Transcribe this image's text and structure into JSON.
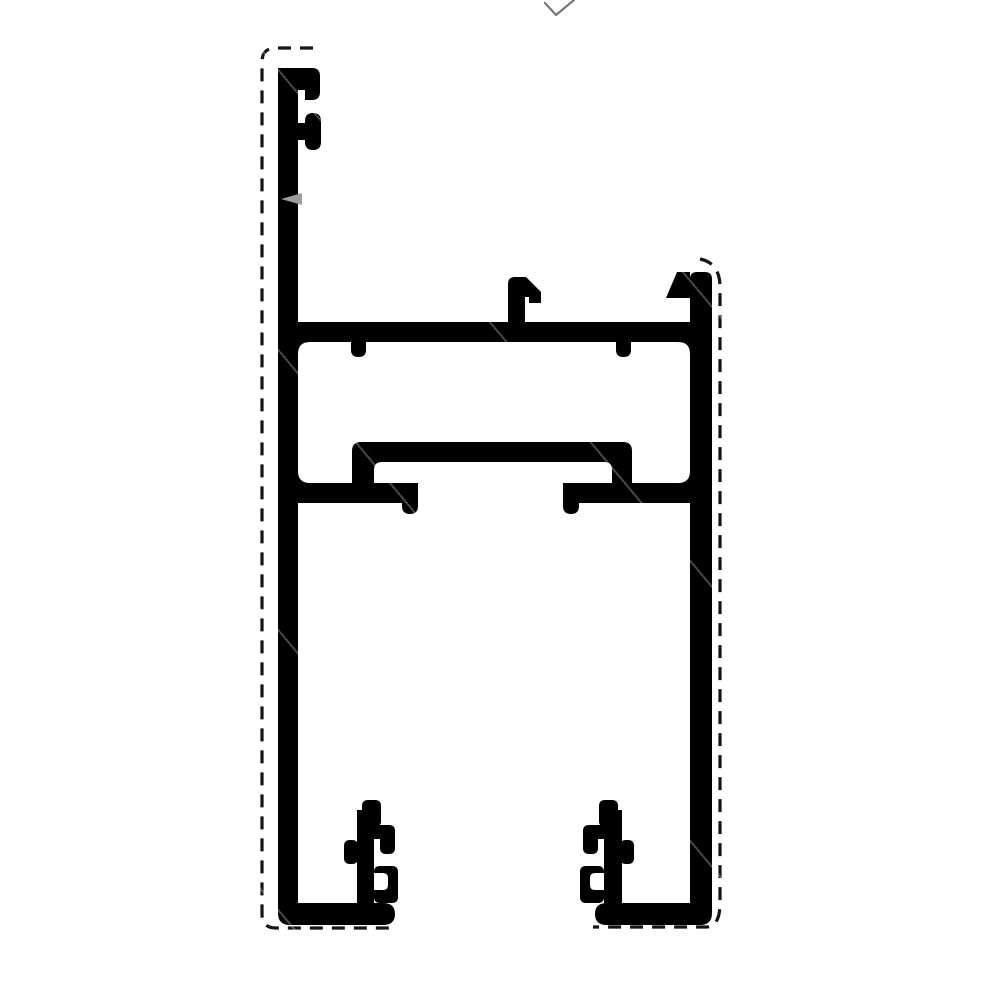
{
  "meta": {
    "title": "Aluminium sliding-frame profile cross-section drawing",
    "canvas": {
      "width": 1000,
      "height": 1000
    }
  },
  "colors": {
    "background": "#ffffff",
    "ink": "#000000",
    "dash": "#151515",
    "pointer": "#9d9d9d",
    "check": "#777777"
  },
  "drawing": {
    "paths": [
      {
        "name": "dashed-outline-left",
        "d": "M313,48 H276 Q262,48 262,62 V914 Q262,928 276,928 H390"
      },
      {
        "name": "dashed-outline-right",
        "d": "M700,259 Q720,263 720,287 V903 Q720,927 706,927 H593"
      },
      {
        "name": "upper-chamber-body",
        "d": "M278,322 H712 V503 H278 Z"
      },
      {
        "name": "upper-chamber-cavity",
        "d": "M310,342 H678 Q690,342 690,354 V471 Q690,483 678,483 H310 Q298,483 298,471 V354 Q298,342 310,342 Z"
      },
      {
        "name": "glazing-hat-body",
        "d": "M352,451 Q352,442 361,442 H623 Q632,442 632,451 V503 H352 Z"
      },
      {
        "name": "glazing-hat-cavity",
        "d": "M382,462 H604 Q612,462 612,470 V483 H374 V470 Q374,462 382,462 Z"
      },
      {
        "name": "under-hat-gap",
        "d": "M418,483 H563 V503 H418 Z"
      },
      {
        "name": "gap-lip-left",
        "d": "M402,494 H418 V506 Q418,514 410,514 Q402,514 402,506 Z"
      },
      {
        "name": "gap-lip-right",
        "d": "M563,494 H579 V506 Q579,514 571,514 Q563,514 563,506 Z"
      },
      {
        "name": "web-nub-left",
        "d": "M351,342 H366 V350 Q366,357 358.5,357 Q351,357 351,350 Z"
      },
      {
        "name": "web-nub-right",
        "d": "M616,342 H631 V350 Q631,357 623.5,357 Q616,357 616,350 Z"
      },
      {
        "name": "center-hook",
        "d": "M508,338 V284 Q508,277 515,277 H526 L541,292 V303 H529 V297 H525 V338 Z"
      },
      {
        "name": "right-top-flag",
        "d": "M677,272 H690 V298 H666 Z"
      },
      {
        "name": "left-wall",
        "d": "M278,75 Q278,68 285,68 H298 V910 H278 Z"
      },
      {
        "name": "left-wall-top-arm",
        "d": "M278,68 H312 Q320,68 320,76 V92 Q320,100 312,100 H305 V90 H278 Z"
      },
      {
        "name": "left-wall-knob",
        "d": "M313,113 Q321,113 321,121 V142 Q321,150 313,150 Q305,150 305,142 V121 Q305,113 313,113 Z M296,123 H306 V140 H296 Z"
      },
      {
        "name": "right-wall",
        "d": "M690,279 Q690,272 697,272 H705 Q712,272 712,279 V910 H690 Z"
      },
      {
        "name": "left-foot-base",
        "d": "M278,888 H298 V903 H383 Q395,903 395,914 Q395,925 383,925 H290 Q278,925 278,913 Z"
      },
      {
        "name": "right-foot-base",
        "d": "M712,888 V913 Q712,925 700,925 H607 Q595,925 595,914 Q595,903 607,903 H690 V888 Z"
      },
      {
        "name": "left-foot-rib",
        "d": "M357,810 H374 V903 H357 Z"
      },
      {
        "name": "left-rib-top-knob",
        "d": "M368,800 H375 Q381,800 381,806 V821 Q381,827 375,827 H368 Q362,827 362,821 V806 Q362,800 368,800 Z"
      },
      {
        "name": "left-rib-finger",
        "d": "M374,825 H389 Q395,825 395,831 V848 Q395,854 389,854 H386 Q380,854 380,848 V839 H374 Z"
      },
      {
        "name": "left-rib-side-knob",
        "d": "M350,840 H352 Q358,840 358,846 V858 Q358,864 352,864 H350 Q344,864 344,858 V846 Q344,840 350,840 Z"
      },
      {
        "name": "left-rib-hook-body",
        "d": "M380,866 H392 Q398,866 398,872 V897 Q398,903 392,903 H380 Q374,903 374,897 V872 Q374,866 380,866 Z"
      },
      {
        "name": "left-rib-hook-notch",
        "d": "M374,873 H383 Q388,873 388,878 V885 Q388,890 383,890 H374 Z"
      },
      {
        "name": "right-foot-rib",
        "d": "M604,810 H622 V903 H604 Z"
      },
      {
        "name": "right-rib-top-knob",
        "d": "M605,800 H612 Q618,800 618,806 V821 Q618,827 612,827 H605 Q599,827 599,821 V806 Q599,800 605,800 Z"
      },
      {
        "name": "right-rib-finger",
        "d": "M604,825 H589 Q583,825 583,831 V848 Q583,854 589,854 H592 Q598,854 598,848 V839 H604 Z"
      },
      {
        "name": "right-rib-side-knob",
        "d": "M626,840 H628 Q634,840 634,846 V858 Q634,864 628,864 H626 Q620,864 620,858 V846 Q620,840 626,840 Z"
      },
      {
        "name": "right-rib-hook-body",
        "d": "M586,866 H598 Q604,866 604,872 V897 Q604,903 598,903 H586 Q580,903 580,897 V872 Q580,866 586,866 Z"
      },
      {
        "name": "right-rib-hook-notch",
        "d": "M604,873 H595 Q590,873 590,878 V885 Q590,890 595,890 H604 Z"
      },
      {
        "name": "pointer-arrow",
        "d": "M281,199 L302,193 L302,205 Z"
      },
      {
        "name": "checkmark",
        "d": "M545,3 L556,15 L574,0"
      }
    ]
  }
}
